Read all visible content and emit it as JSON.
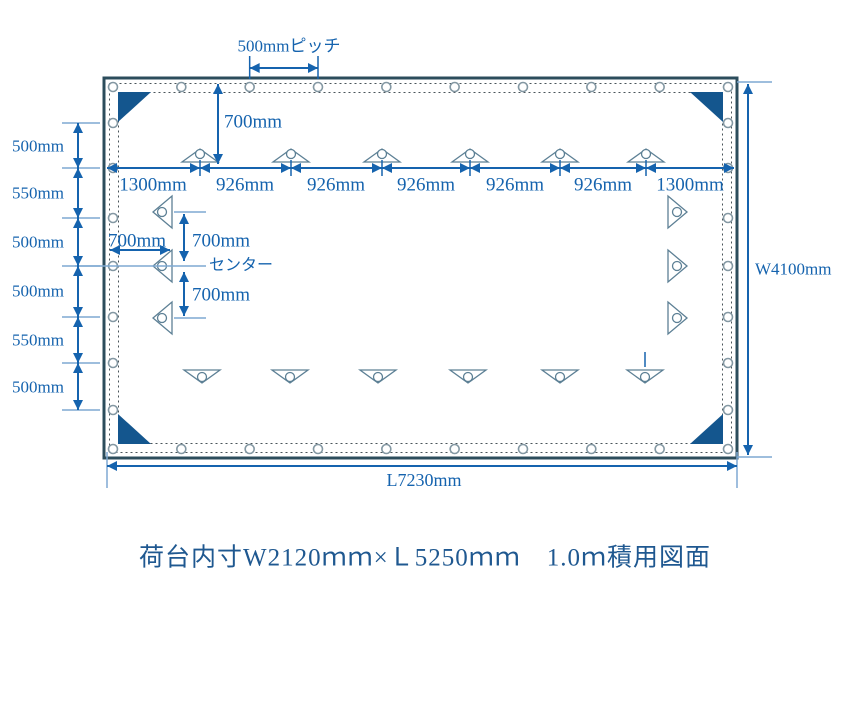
{
  "colors": {
    "dimension_blue": "#1563ae",
    "light_blue": "#7fa9d2",
    "tarp_border": "#2c4d5c",
    "corner_patch_blue": "#14568e",
    "hook_outline": "#5d8095",
    "grommet_outline": "#8498a3",
    "hem_dotted": "#4a545a",
    "title_blue": "#1f5890",
    "background": "#ffffff"
  },
  "annotations": {
    "pitch_label": "500mmピッチ",
    "top_offset_label": "700mm",
    "top_row_segments": [
      "1300mm",
      "926mm",
      "926mm",
      "926mm",
      "926mm",
      "926mm",
      "1300mm"
    ],
    "left_column_segments": [
      "500mm",
      "550mm",
      "500mm",
      "500mm",
      "550mm",
      "500mm"
    ],
    "left_offset_label": "700mm",
    "center_upper_label": "700mm",
    "center_lower_label": "700mm",
    "center_line_label": "センター",
    "width_label": "W4100mm",
    "length_label": "L7230mm"
  },
  "caption": {
    "title": "荷台内寸W2120ｍｍ×Ｌ5250ｍｍ　1.0ｍ積用図面"
  }
}
